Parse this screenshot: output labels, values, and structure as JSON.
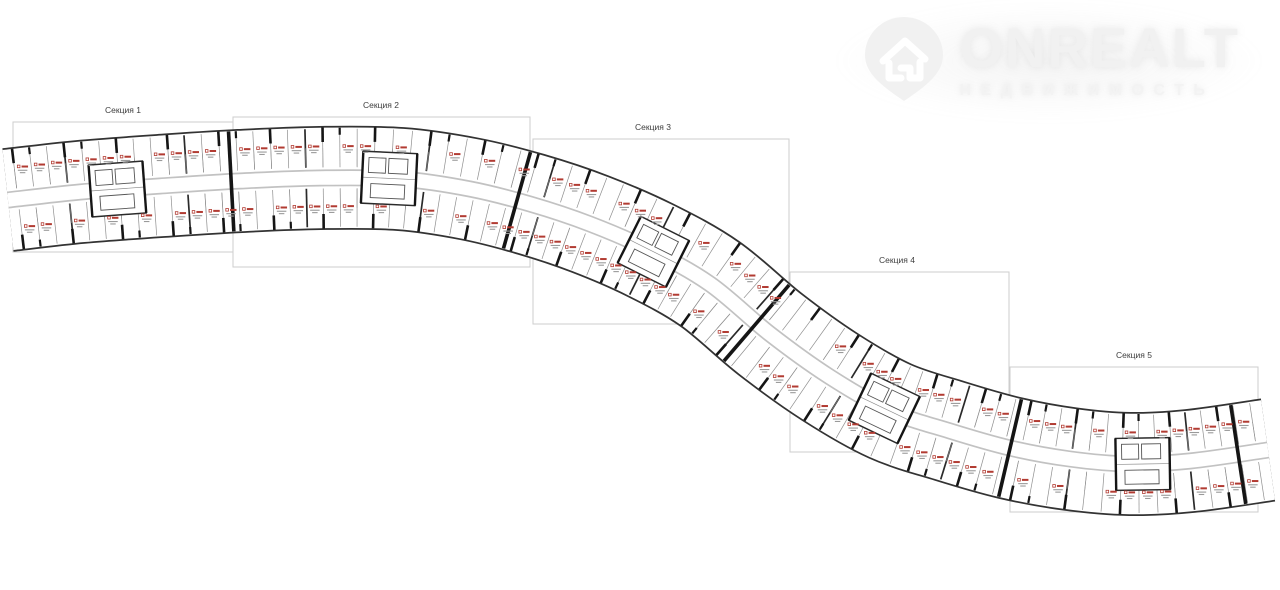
{
  "page": {
    "width": 1280,
    "height": 590,
    "background": "#ffffff"
  },
  "logo": {
    "title": "ONREALT",
    "subtitle": "НЕДВИЖИМОСТЬ",
    "icon": "map-pin-house-icon",
    "color": "#f1f1f1"
  },
  "plan": {
    "type": "residential-building-floor-plan",
    "shape": "serpentine-band",
    "sections": [
      {
        "label": "Секция 1"
      },
      {
        "label": "Секция 2"
      },
      {
        "label": "Секция 3"
      },
      {
        "label": "Секция 4"
      },
      {
        "label": "Секция 5"
      }
    ],
    "colors": {
      "band_edge": "#333333",
      "wall_black": "#151515",
      "thin_line": "#8f8f8f",
      "interior_wall": "#2a2a2a",
      "corridor_line": "#c2c2c2",
      "section_box_border": "#cdcdcd",
      "section_label": "#3d3d3d",
      "unit_marker_red": "#b23b32",
      "unit_text_gray": "#9a9a9a",
      "core_line": "#555555"
    }
  }
}
